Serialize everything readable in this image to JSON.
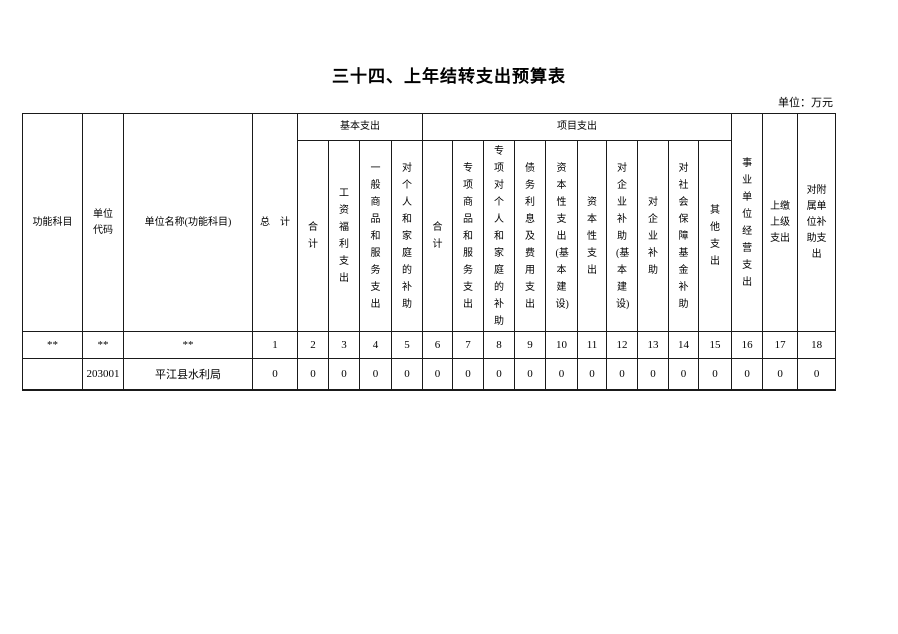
{
  "page": {
    "title": "三十四、上年结转支出预算表",
    "unit_note": "单位：万元"
  },
  "table": {
    "group_headers": {
      "basic": "基本支出",
      "project": "项目支出"
    },
    "headers": [
      "功能科目",
      "单位代码",
      "单位名称(功能科目)",
      "总　计",
      "合计",
      "工资福利支出",
      "一般商品和服务支出",
      "对个人和家庭的补助",
      "合计",
      "专项商品和服务支出",
      "专项对个人和家庭的补助",
      "债务利息及费用支出",
      "资本性支出(基本建设)",
      "资本性支出",
      "对企业补助(基本建设)",
      "对企业补助",
      "对社会保障基金补助",
      "其他支出",
      "事业单位经营支出",
      "上缴上级支出",
      "对附属单位补助支出"
    ],
    "numbering_row": [
      "**",
      "**",
      "**",
      "1",
      "2",
      "3",
      "4",
      "5",
      "6",
      "7",
      "8",
      "9",
      "10",
      "11",
      "12",
      "13",
      "14",
      "15",
      "16",
      "17",
      "18"
    ],
    "rows": [
      [
        "",
        "203001",
        "平江县水利局",
        "0",
        "0",
        "0",
        "0",
        "0",
        "0",
        "0",
        "0",
        "0",
        "0",
        "0",
        "0",
        "0",
        "0",
        "0",
        "0",
        "0",
        "0"
      ]
    ]
  }
}
